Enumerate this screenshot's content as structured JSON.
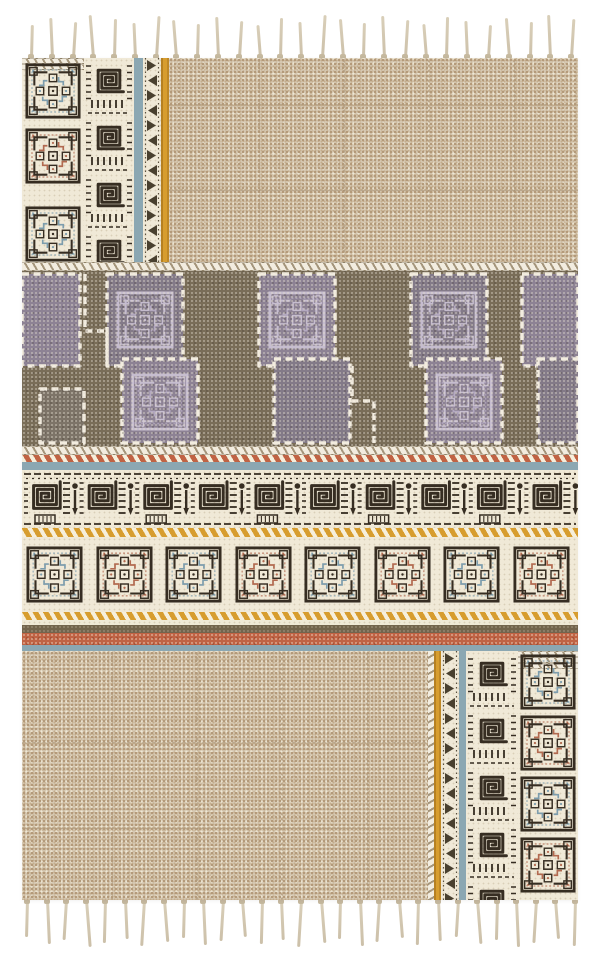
{
  "scene": {
    "type": "product-photo",
    "subject": "hand-block-printed flatweave boho area rug with tasseled fringe, patchwork of beige grid fields, tribal spiral borders and stepped patchwork band",
    "background_color": "#ffffff"
  },
  "palette": {
    "beige_field": "#d7cab5",
    "cream": "#f0e9d7",
    "ink": "#362d22",
    "blue_accent": "#7d9dad",
    "blue_stripe": "#8ba7b2",
    "red_accent": "#b26a50",
    "yellow": "#d79d2f",
    "rust_stripe": "#c06344",
    "brown_stripe": "#73644d",
    "olive_band": "#796d58",
    "purple_block_a": "#8d8294",
    "purple_block_b": "#837a88",
    "purple_block_dark": "#7d7468",
    "lavender": "#cdc4d6",
    "lavender_deep": "#b9aec6",
    "stitch_white": "#f2ecdf",
    "rope_dark": "#a4957b",
    "fringe": "#d9cfb9",
    "fringe_knot": "#c6b99f",
    "triangle_glyph": "#49402f"
  },
  "fringe": {
    "top_count": 27,
    "bottom_count": 29
  },
  "borders": {
    "left_column_medallion_accents": [
      "blue",
      "red",
      "blue"
    ],
    "right_column_medallion_accents": [
      "blue",
      "red",
      "blue",
      "red"
    ],
    "medallion_row_accents": [
      "blue",
      "red",
      "blue",
      "red",
      "blue",
      "red",
      "blue",
      "red"
    ],
    "left_spiral_units": 4,
    "right_spiral_units": 5,
    "glyph_band_units": 10,
    "triangle_stripe_step": 15
  },
  "middle_band": {
    "top_blocks": [
      [
        0,
        58,
        3,
        92
      ],
      [
        85,
        76,
        3,
        92
      ],
      [
        237,
        76,
        3,
        92
      ],
      [
        389,
        76,
        3,
        92
      ],
      [
        500,
        56,
        3,
        92
      ]
    ],
    "bottom_blocks": [
      [
        18,
        44,
        118,
        54
      ],
      [
        100,
        76,
        88,
        84
      ],
      [
        252,
        76,
        88,
        84
      ],
      [
        404,
        76,
        88,
        84
      ],
      [
        516,
        40,
        88,
        84
      ]
    ],
    "maze_medallions": [
      [
        123,
        49
      ],
      [
        275,
        49
      ],
      [
        427,
        49
      ],
      [
        138,
        131
      ],
      [
        442,
        131
      ]
    ]
  }
}
